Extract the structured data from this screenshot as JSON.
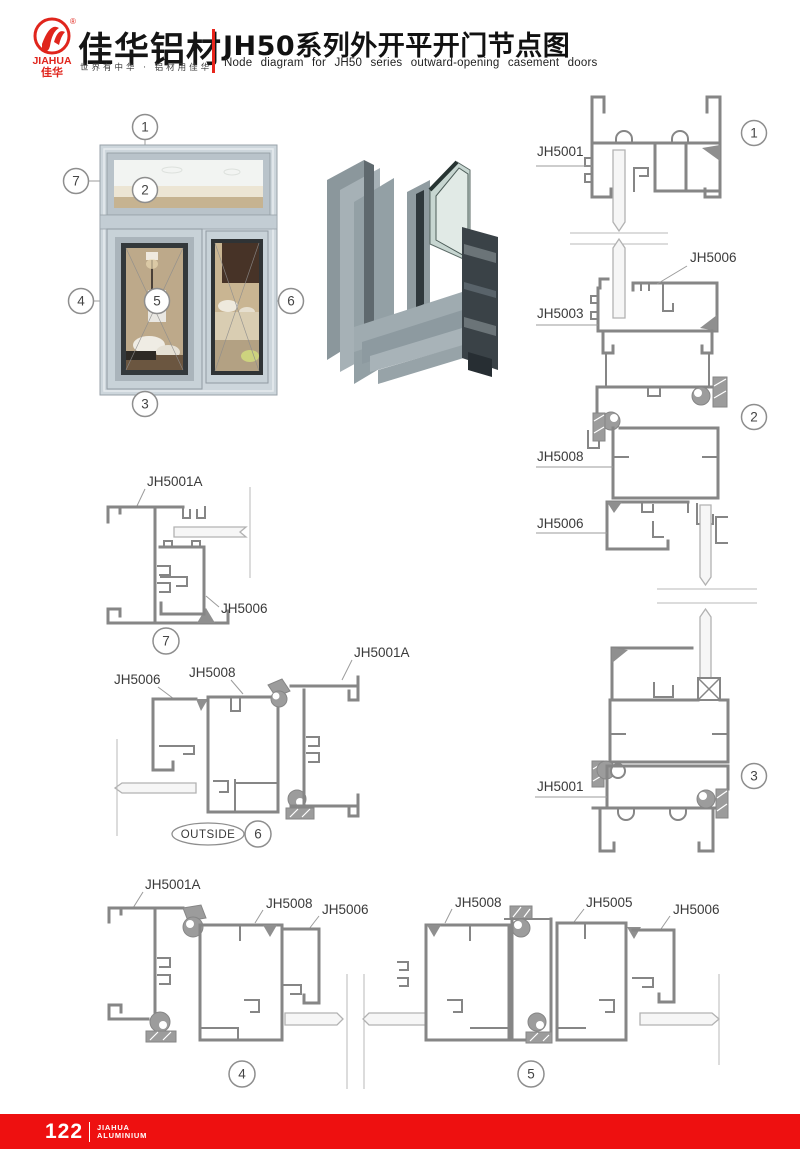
{
  "header": {
    "logo_brand_en": "JIAHUA",
    "logo_brand_cn": "佳华",
    "registered_mark": "®",
    "brand_cn_large": "佳华铝材",
    "tagline": "世界有中华 · 铝材用佳华",
    "title_cn": "JH50系列外开平开门节点图",
    "title_en": "Node diagram for JH50 series outward-opening casement doors"
  },
  "overview": {
    "callout_1": "1",
    "callout_2": "2",
    "callout_3": "3",
    "callout_4": "4",
    "callout_5": "5",
    "callout_6": "6",
    "callout_7": "7"
  },
  "sections": {
    "s1": {
      "num": "1",
      "jh5001": "JH5001",
      "jh5006": "JH5006",
      "jh5003": "JH5003"
    },
    "s2": {
      "num": "2",
      "jh5008": "JH5008",
      "jh5006": "JH5006"
    },
    "s3": {
      "num": "3",
      "jh5001": "JH5001"
    },
    "s7": {
      "num": "7",
      "jh5001a": "JH5001A",
      "jh5006": "JH5006"
    },
    "s6": {
      "num": "6",
      "jh5006": "JH5006",
      "jh5008": "JH5008",
      "jh5001a": "JH5001A",
      "outside": "OUTSIDE"
    },
    "s4": {
      "num": "4",
      "jh5001a": "JH5001A",
      "jh5008": "JH5008",
      "jh5006": "JH5006"
    },
    "s5": {
      "num": "5",
      "jh5008": "JH5008",
      "jh5005": "JH5005",
      "jh5006": "JH5006"
    }
  },
  "footer": {
    "page_number": "122",
    "brand_line1": "JIAHUA",
    "brand_line2": "ALUMINIUM"
  },
  "colors": {
    "accent_red": "#ee1010",
    "logo_red": "#e0251c",
    "line_gray": "#868686",
    "label_gray": "#3a3a3a"
  }
}
